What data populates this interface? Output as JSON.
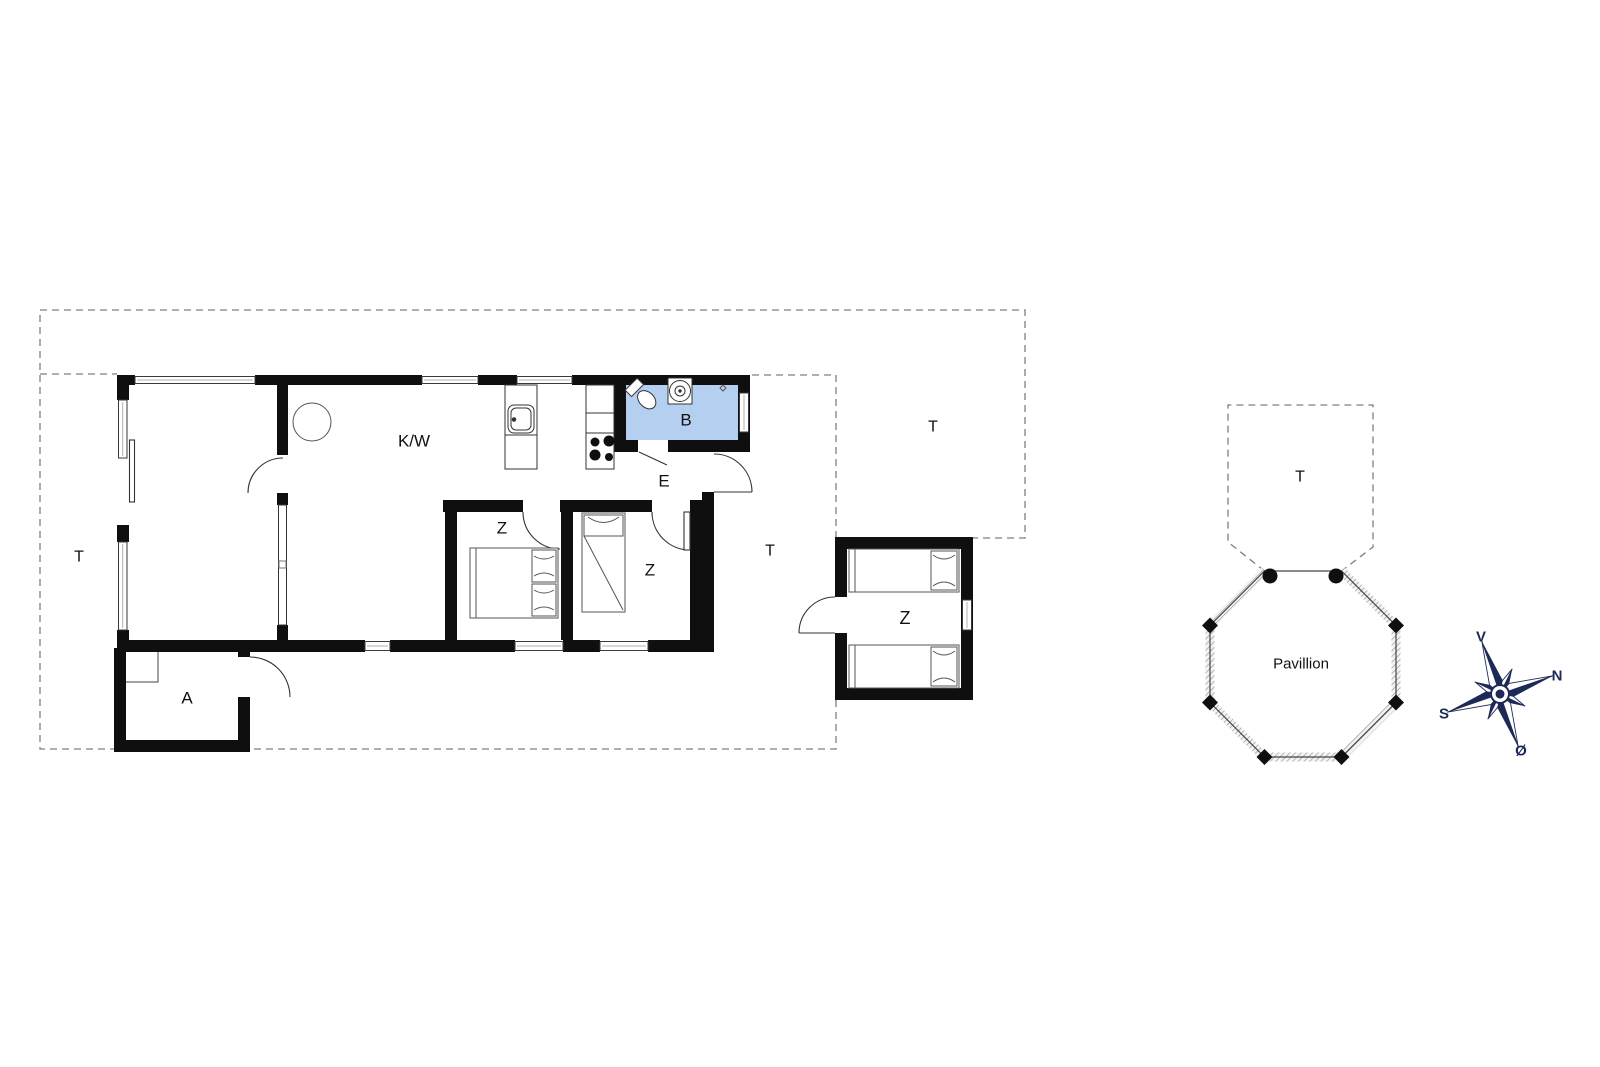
{
  "page": {
    "background": "#ffffff"
  },
  "colors": {
    "wall": "#0f0f0f",
    "bathroom_fill": "#b5cff1",
    "dashed_line": "#7f7f7f",
    "compass_navy": "#1d2a57"
  },
  "rooms": {
    "kitchen_living": "K/W",
    "bathroom": "B",
    "entry": "E",
    "bedroom_1": "Z",
    "bedroom_2": "Z",
    "annex_bedroom": "Z",
    "annex_room": "A",
    "pavilion": "Pavillion"
  },
  "terraces": {
    "left": "T",
    "top_right": "T",
    "east": "T",
    "pavilion": "T"
  },
  "compass": {
    "west": "V",
    "north": "N",
    "south": "S",
    "east": "Ø"
  }
}
